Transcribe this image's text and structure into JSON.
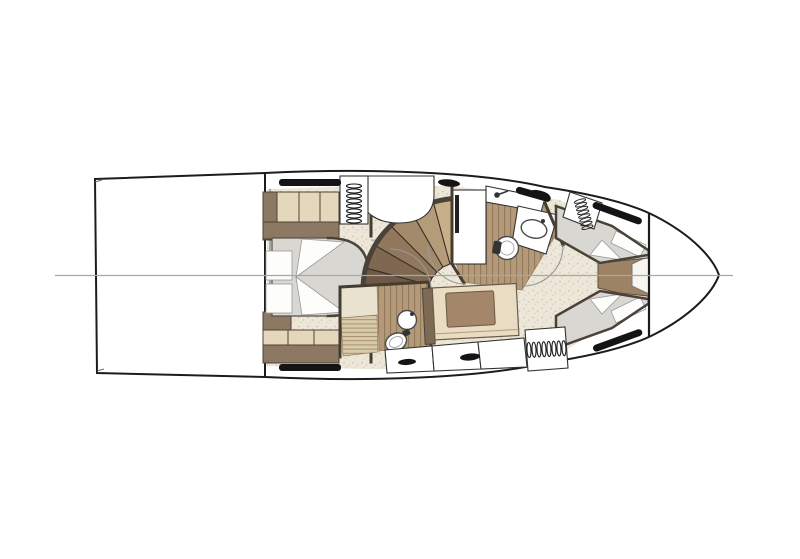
{
  "diagram": {
    "type": "yacht-deck-plan",
    "view": "top-down lower-deck accommodation floor plan of a motor yacht, bow pointing right",
    "regions": [
      {
        "id": "stern-platform",
        "desc": "large empty rectangle at stern (engine room / cockpit footprint)"
      },
      {
        "id": "aft-master-cabin",
        "desc": "aft cabin with island double bed, pillows aft, wardrobes port and starboard"
      },
      {
        "id": "companionway-stairs",
        "desc": "curved fan staircase of wooden steps down from main deck"
      },
      {
        "id": "midship-lobby",
        "desc": "speckled-floor lobby between cabins"
      },
      {
        "id": "forward-head",
        "desc": "bathroom with shower, round toilet and oval sink on teak floor"
      },
      {
        "id": "day-head",
        "desc": "second bathroom aft-starboard with toilet, round sink and slatted shower mat"
      },
      {
        "id": "settee",
        "desc": "straight settee with brown cushion, drawers below"
      },
      {
        "id": "forward-vip-cabin",
        "desc": "bow cabin with two angled single berths meeting at a tan infill wedge"
      },
      {
        "id": "bow",
        "desc": "empty white bow section forward of collision bulkhead"
      }
    ]
  },
  "icons": [
    {
      "name": "hanging-locker-icon",
      "meaning": "row of small loops = wardrobe hanging space"
    },
    {
      "name": "deck-hatch-icon",
      "meaning": "black oval = deck hatch / handle"
    },
    {
      "name": "hull-window-icon",
      "meaning": "black sliver strip = hull window"
    },
    {
      "name": "toilet-icon",
      "meaning": "round/oval bowl with dark tank"
    },
    {
      "name": "sink-icon",
      "meaning": "round or oval basin with faucet dot"
    },
    {
      "name": "shower-faucet-icon",
      "meaning": "small circle with lever"
    },
    {
      "name": "door-swing-icon",
      "meaning": "thin quarter-circle arc"
    },
    {
      "name": "centerline-icon",
      "meaning": "gray horizontal hull centerline"
    }
  ],
  "colors": {
    "background": "#ffffff",
    "deck_white": "#ffffff",
    "hull_outline": "#1c1c1c",
    "centerline": "#a8a8a8",
    "floor_speckle_base": "#ece7d8",
    "wood_floor": "#b49a78",
    "teak_mat": "#d8cbab",
    "wall_dark": "#463c30",
    "trim_brown": "#7d6a55",
    "wardrobe_dark": "#8d7963",
    "wardrobe_light": "#e5d7bc",
    "bed_gray": "#d9d7d1",
    "linen_white": "#fdfdfc",
    "sofa_beige": "#e9dcc3",
    "cushion_brown": "#a4876a",
    "infill_tan": "#9e8264",
    "shower_pale": "#e9e2cf",
    "window_black": "#141414",
    "apex_white": "#f7f5f0",
    "stair_steps": [
      "#6e5947",
      "#7f6852",
      "#90775d",
      "#a28a6a",
      "#b49c79",
      "#c7af8a"
    ]
  }
}
